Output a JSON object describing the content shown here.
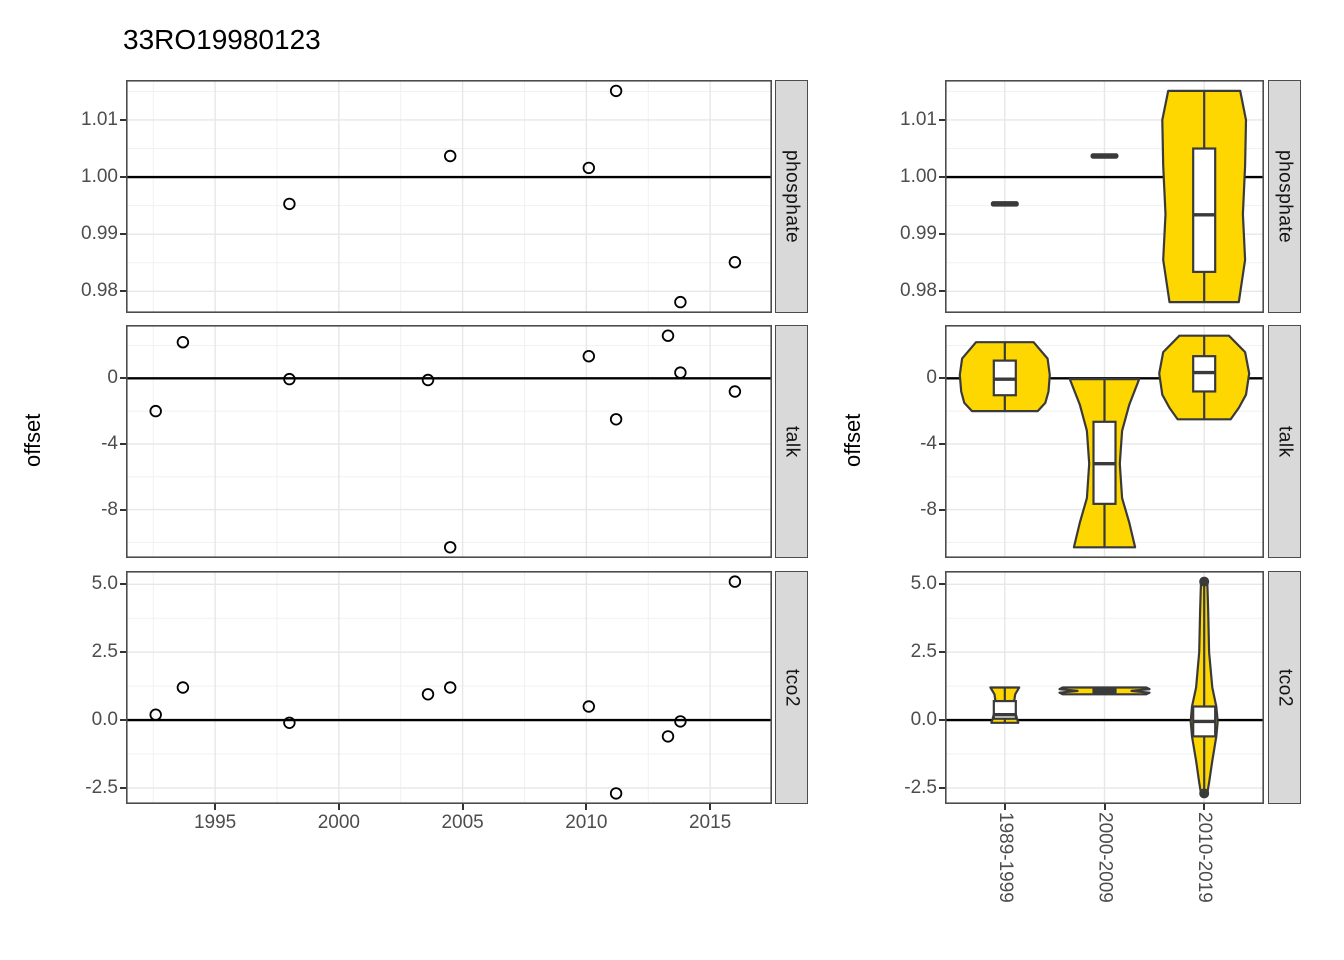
{
  "title": "33RO19980123",
  "colors": {
    "violin_fill": "#FFD700",
    "outline": "#3A3A3A",
    "strip_bg": "#D9D9D9",
    "strip_border": "#4D4D4D",
    "panel_border": "#4D4D4D",
    "grid_major": "#E7E7E7",
    "grid_minor": "#F1F1F1",
    "axis_text": "#4D4D4D",
    "ref_line": "#000000",
    "point_stroke": "#000000",
    "box_fill": "#FFFFFF"
  },
  "chart_data": [
    {
      "type": "scatter",
      "title": "33RO19980123",
      "xlabel": "",
      "ylabel": "offset",
      "x_range": [
        1991.4,
        2017.5
      ],
      "x_ticks": [
        {
          "v": 1995,
          "label": "1995"
        },
        {
          "v": 2000,
          "label": "2000"
        },
        {
          "v": 2005,
          "label": "2005"
        },
        {
          "v": 2010,
          "label": "2010"
        },
        {
          "v": 2015,
          "label": "2015"
        }
      ],
      "facets": [
        {
          "label": "phosphate",
          "ref_line": 1.0,
          "y_range": [
            0.9762,
            1.017
          ],
          "y_ticks": [
            {
              "v": 0.98,
              "label": "0.98"
            },
            {
              "v": 0.99,
              "label": "0.99"
            },
            {
              "v": 1.0,
              "label": "1.00"
            },
            {
              "v": 1.01,
              "label": "1.01"
            }
          ],
          "points": [
            [
              1998.0,
              0.9953
            ],
            [
              2004.5,
              1.0037
            ],
            [
              2010.1,
              1.0016
            ],
            [
              2011.2,
              1.0151
            ],
            [
              2013.8,
              0.9781
            ],
            [
              2016.0,
              0.9851
            ]
          ]
        },
        {
          "label": "talk",
          "ref_line": 0,
          "y_range": [
            -10.95,
            3.25
          ],
          "y_ticks": [
            {
              "v": -8,
              "label": "-8"
            },
            {
              "v": -4,
              "label": "-4"
            },
            {
              "v": 0,
              "label": "0"
            }
          ],
          "points": [
            [
              1992.6,
              -2.0
            ],
            [
              1993.7,
              2.2
            ],
            [
              1998.0,
              -0.05
            ],
            [
              2003.6,
              -0.1
            ],
            [
              2004.5,
              -10.3
            ],
            [
              2010.1,
              1.35
            ],
            [
              2011.2,
              -2.5
            ],
            [
              2013.3,
              2.6
            ],
            [
              2013.8,
              0.35
            ],
            [
              2016.0,
              -0.8
            ]
          ]
        },
        {
          "label": "tco2",
          "ref_line": 0,
          "y_range": [
            -3.09,
            5.49
          ],
          "y_ticks": [
            {
              "v": -2.5,
              "label": "-2.5"
            },
            {
              "v": 0,
              "label": "0.0"
            },
            {
              "v": 2.5,
              "label": "2.5"
            },
            {
              "v": 5,
              "label": "5.0"
            }
          ],
          "points": [
            [
              1992.6,
              0.2
            ],
            [
              1993.7,
              1.2
            ],
            [
              1998.0,
              -0.1
            ],
            [
              2003.6,
              0.95
            ],
            [
              2004.5,
              1.2
            ],
            [
              2010.1,
              0.5
            ],
            [
              2011.2,
              -2.7
            ],
            [
              2013.3,
              -0.6
            ],
            [
              2013.8,
              -0.05
            ],
            [
              2016.0,
              5.1
            ]
          ]
        }
      ]
    },
    {
      "type": "violin-box",
      "ylabel": "offset",
      "categories": [
        "1989-1999",
        "2000-2009",
        "2010-2019"
      ],
      "facets": [
        {
          "label": "phosphate",
          "ref_line": 1.0,
          "y_range": [
            0.9762,
            1.017
          ],
          "y_ticks": [
            {
              "v": 0.98,
              "label": "0.98"
            },
            {
              "v": 0.99,
              "label": "0.99"
            },
            {
              "v": 1.0,
              "label": "1.00"
            },
            {
              "v": 1.01,
              "label": "1.01"
            }
          ],
          "groups": [
            {
              "category": "1989-1999",
              "values": [
                0.9953
              ]
            },
            {
              "category": "2000-2009",
              "values": [
                1.0037
              ]
            },
            {
              "category": "2010-2019",
              "values": [
                0.9781,
                0.9851,
                1.0016,
                1.0151
              ],
              "box": {
                "q1": 0.9834,
                "median": 0.9934,
                "q3": 1.005
              },
              "violin": [
                [
                  1.0151,
                  0.8
                ],
                [
                  1.01,
                  0.93
                ],
                [
                  1.002,
                  0.91
                ],
                [
                  0.9935,
                  0.86
                ],
                [
                  0.9855,
                  0.91
                ],
                [
                  0.9781,
                  0.77
                ]
              ]
            }
          ]
        },
        {
          "label": "talk",
          "ref_line": 0,
          "y_range": [
            -10.95,
            3.25
          ],
          "y_ticks": [
            {
              "v": -8,
              "label": "-8"
            },
            {
              "v": -4,
              "label": "-4"
            },
            {
              "v": 0,
              "label": "0"
            }
          ],
          "groups": [
            {
              "category": "1989-1999",
              "values": [
                -2.0,
                -0.05,
                2.2
              ],
              "box": {
                "q1": -1.03,
                "median": -0.05,
                "q3": 1.08
              },
              "violin": [
                [
                  2.2,
                  0.64
                ],
                [
                  1.2,
                  0.95
                ],
                [
                  0.2,
                  1.0
                ],
                [
                  -0.8,
                  0.97
                ],
                [
                  -1.5,
                  0.9
                ],
                [
                  -2.0,
                  0.73
                ]
              ]
            },
            {
              "category": "2000-2009",
              "values": [
                -10.3,
                -0.1
              ],
              "box": {
                "q1": -7.65,
                "median": -5.2,
                "q3": -2.65
              },
              "violin": [
                [
                  -0.05,
                  0.77
                ],
                [
                  -1.6,
                  0.55
                ],
                [
                  -3.2,
                  0.39
                ],
                [
                  -5.2,
                  0.34
                ],
                [
                  -7.3,
                  0.39
                ],
                [
                  -8.8,
                  0.55
                ],
                [
                  -10.3,
                  0.68
                ]
              ]
            },
            {
              "category": "2010-2019",
              "values": [
                -2.5,
                -0.8,
                0.35,
                1.35,
                2.6
              ],
              "box": {
                "q1": -0.8,
                "median": 0.35,
                "q3": 1.35
              },
              "violin": [
                [
                  2.6,
                  0.55
                ],
                [
                  1.6,
                  0.91
                ],
                [
                  0.3,
                  1.0
                ],
                [
                  -1.0,
                  0.93
                ],
                [
                  -1.8,
                  0.77
                ],
                [
                  -2.5,
                  0.59
                ]
              ]
            }
          ]
        },
        {
          "label": "tco2",
          "ref_line": 0,
          "y_range": [
            -3.09,
            5.49
          ],
          "y_ticks": [
            {
              "v": -2.5,
              "label": "-2.5"
            },
            {
              "v": 0,
              "label": "0.0"
            },
            {
              "v": 2.5,
              "label": "2.5"
            },
            {
              "v": 5,
              "label": "5.0"
            }
          ],
          "groups": [
            {
              "category": "1989-1999",
              "values": [
                -0.1,
                0.2,
                1.2
              ],
              "box": {
                "q1": 0.05,
                "median": 0.2,
                "q3": 0.7
              },
              "violin": [
                [
                  1.2,
                  0.32
                ],
                [
                  0.95,
                  0.23
                ],
                [
                  0.6,
                  0.2
                ],
                [
                  0.3,
                  0.23
                ],
                [
                  0.05,
                  0.27
                ],
                [
                  -0.1,
                  0.3
                ]
              ]
            },
            {
              "category": "2000-2009",
              "values": [
                0.95,
                1.2
              ],
              "box": {
                "q1": 1.01,
                "median": 1.08,
                "q3": 1.14
              },
              "violin": [
                [
                  1.2,
                  0.93
                ],
                [
                  1.14,
                  1.0
                ],
                [
                  1.075,
                  0.6
                ],
                [
                  1.01,
                  1.0
                ],
                [
                  0.95,
                  0.93
                ]
              ]
            },
            {
              "category": "2010-2019",
              "values": [
                -2.7,
                -0.6,
                -0.05,
                0.5,
                5.1
              ],
              "box": {
                "q1": -0.6,
                "median": -0.05,
                "q3": 0.5
              },
              "outliers": [
                5.1,
                -2.7
              ],
              "violin": [
                [
                  5.1,
                  0.07
                ],
                [
                  4.0,
                  0.09
                ],
                [
                  2.5,
                  0.11
                ],
                [
                  1.2,
                  0.18
                ],
                [
                  0.5,
                  0.27
                ],
                [
                  -0.05,
                  0.3
                ],
                [
                  -0.6,
                  0.27
                ],
                [
                  -1.5,
                  0.18
                ],
                [
                  -2.3,
                  0.11
                ],
                [
                  -2.7,
                  0.07
                ]
              ]
            }
          ]
        }
      ]
    }
  ]
}
